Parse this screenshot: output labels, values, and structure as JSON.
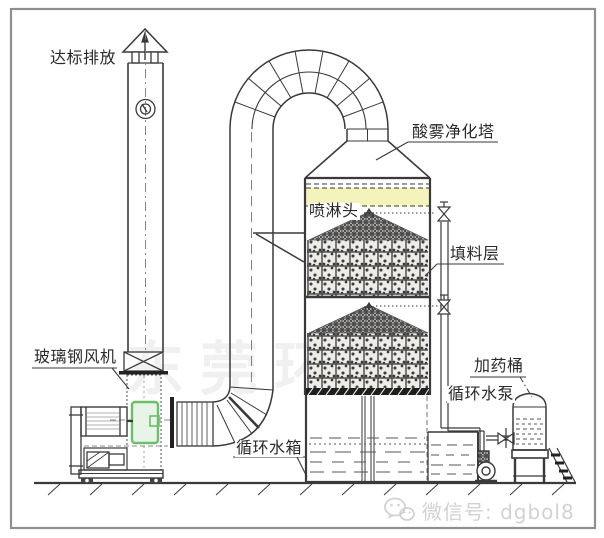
{
  "labels": {
    "emission_outlet": "达标排放",
    "purification_tower": "酸雾净化塔",
    "spray_head": "喷淋头",
    "packing_layer": "填料层",
    "frp_fan": "玻璃钢风机",
    "circulating_water_tank": "循环水箱",
    "dosing_barrel": "加药桶",
    "circulating_water_pump": "循环水泵"
  },
  "watermark": {
    "icon": "wechat-icon",
    "text": "微信号: dgbol8",
    "background_text": "东莞环保"
  },
  "colors": {
    "line": "#3a3a3a",
    "demister_band": "#f3f3bb",
    "fan_inlet_highlight": "#6abf69",
    "support_band": "#1e1e1e",
    "watermark_gray": "#d2d2d2"
  }
}
